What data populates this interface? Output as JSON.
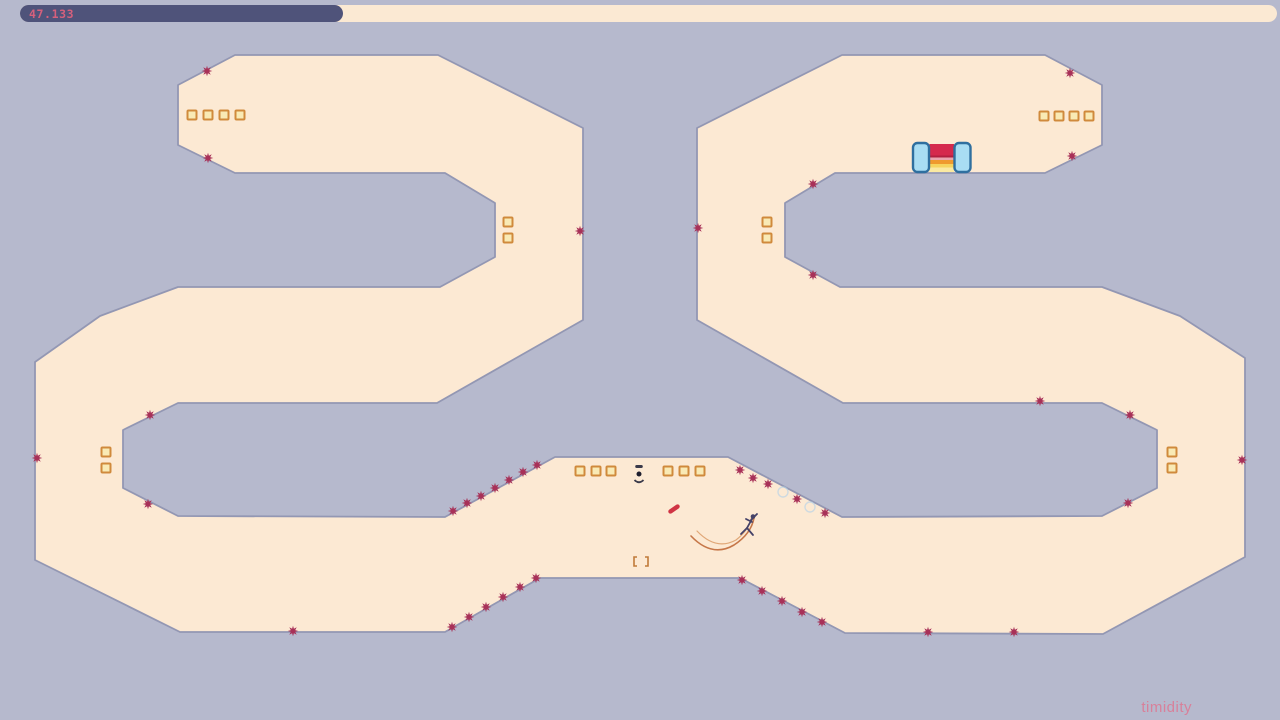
{
  "hud": {
    "timer_label": "47.133",
    "track": {
      "x": 20,
      "y": 5,
      "w": 1257,
      "h": 17,
      "color": "#fbe9d3"
    },
    "fill": {
      "w": 323,
      "color": "#4f537a"
    },
    "label_color": "#d6607c"
  },
  "level": {
    "name": "timidity",
    "name_color": "#d8809a",
    "name_right": 88,
    "name_bottom": 4,
    "colors": {
      "background": "#b6b9cd",
      "ground": "#fce9d3",
      "edge": "#9397b3",
      "edge_width": 1.8,
      "mine": "#a83158",
      "gold_fill": "#f9eab5",
      "gold_border": "#d08a3c",
      "ninja": "#454268",
      "trail_dark": "#c06a3a",
      "trail_light": "#dda06d",
      "rocket": "#d03444",
      "door_pillar_fill": "#a9ddf3",
      "door_pillar_stroke": "#2f6f9f",
      "switch_dark": "#3a3a4a",
      "switch_dot": "#1e1e2e",
      "bracket": "#c07a3a",
      "ghost_circle": "#b5d2e8"
    },
    "terrain_outline": [
      [
        235,
        55
      ],
      [
        438,
        55
      ],
      [
        583,
        128
      ],
      [
        583,
        320
      ],
      [
        437,
        403
      ],
      [
        178,
        403
      ],
      [
        123,
        430
      ],
      [
        123,
        488
      ],
      [
        178,
        516
      ],
      [
        445,
        517
      ],
      [
        555,
        457
      ],
      [
        728,
        457
      ],
      [
        842,
        517
      ],
      [
        1102,
        516
      ],
      [
        1157,
        488
      ],
      [
        1157,
        430
      ],
      [
        1102,
        403
      ],
      [
        843,
        403
      ],
      [
        697,
        320
      ],
      [
        697,
        128
      ],
      [
        842,
        55
      ],
      [
        1045,
        55
      ],
      [
        1102,
        85
      ],
      [
        1102,
        145
      ],
      [
        1045,
        173
      ],
      [
        835,
        173
      ],
      [
        785,
        203
      ],
      [
        785,
        257
      ],
      [
        840,
        287
      ],
      [
        1102,
        287
      ],
      [
        1180,
        316
      ],
      [
        1245,
        358
      ],
      [
        1245,
        557
      ],
      [
        1103,
        634
      ],
      [
        845,
        633
      ],
      [
        740,
        578
      ],
      [
        540,
        578
      ],
      [
        445,
        632
      ],
      [
        180,
        632
      ],
      [
        35,
        560
      ],
      [
        35,
        362
      ],
      [
        100,
        316
      ],
      [
        178,
        287
      ],
      [
        440,
        287
      ],
      [
        495,
        257
      ],
      [
        495,
        203
      ],
      [
        445,
        173
      ],
      [
        235,
        173
      ],
      [
        178,
        145
      ],
      [
        178,
        85
      ]
    ],
    "mines": [
      [
        207,
        71
      ],
      [
        208,
        158
      ],
      [
        580,
        231
      ],
      [
        150,
        415
      ],
      [
        148,
        504
      ],
      [
        37,
        458
      ],
      [
        293,
        631
      ],
      [
        452,
        627
      ],
      [
        469,
        617
      ],
      [
        486,
        607
      ],
      [
        503,
        597
      ],
      [
        520,
        587
      ],
      [
        536,
        578
      ],
      [
        453,
        511
      ],
      [
        467,
        503
      ],
      [
        481,
        496
      ],
      [
        495,
        488
      ],
      [
        509,
        480
      ],
      [
        523,
        472
      ],
      [
        537,
        465
      ],
      [
        740,
        470
      ],
      [
        753,
        478
      ],
      [
        768,
        484
      ],
      [
        797,
        499
      ],
      [
        825,
        513
      ],
      [
        742,
        580
      ],
      [
        762,
        591
      ],
      [
        782,
        601
      ],
      [
        802,
        612
      ],
      [
        822,
        622
      ],
      [
        928,
        632
      ],
      [
        1014,
        632
      ],
      [
        1040,
        401
      ],
      [
        1130,
        415
      ],
      [
        1128,
        503
      ],
      [
        1242,
        460
      ],
      [
        698,
        228
      ],
      [
        813,
        184
      ],
      [
        813,
        275
      ],
      [
        1070,
        73
      ],
      [
        1072,
        156
      ]
    ],
    "golds": [
      [
        192,
        115
      ],
      [
        208,
        115
      ],
      [
        224,
        115
      ],
      [
        240,
        115
      ],
      [
        1044,
        116
      ],
      [
        1059,
        116
      ],
      [
        1074,
        116
      ],
      [
        1089,
        116
      ],
      [
        508,
        222
      ],
      [
        508,
        238
      ],
      [
        767,
        222
      ],
      [
        767,
        238
      ],
      [
        106,
        452
      ],
      [
        106,
        468
      ],
      [
        1172,
        452
      ],
      [
        1172,
        468
      ],
      [
        580,
        471
      ],
      [
        596,
        471
      ],
      [
        611,
        471
      ],
      [
        668,
        471
      ],
      [
        684,
        471
      ],
      [
        700,
        471
      ]
    ],
    "gold_size": 9,
    "exit_door": {
      "stripes_x": 929.5,
      "stripes_w": 24.5,
      "stripes": [
        {
          "y": 144,
          "h": 12,
          "color": "#d5294d"
        },
        {
          "y": 155.5,
          "h": 2,
          "color": "#b21f40"
        },
        {
          "y": 157.5,
          "h": 2.5,
          "color": "#eaa3ad"
        },
        {
          "y": 160,
          "h": 4,
          "color": "#ef9a2e"
        },
        {
          "y": 164,
          "h": 3.5,
          "color": "#f6d45e"
        },
        {
          "y": 167.5,
          "h": 4.5,
          "color": "#fae9a2"
        }
      ],
      "left_pillar": {
        "x": 913,
        "y": 143,
        "w": 16,
        "h": 29
      },
      "right_pillar": {
        "x": 954.5,
        "y": 143,
        "w": 16,
        "h": 29
      }
    },
    "door_switch": {
      "x": 639,
      "y": 474
    },
    "trapdoor_brackets": {
      "x1": 634,
      "x2": 648,
      "top": 557,
      "bottom": 566
    },
    "rocket": {
      "x": 674,
      "y": 509,
      "len": 13,
      "w": 4.4,
      "angle": -35
    },
    "ninja": {
      "head": [
        753,
        516.5,
        2.3
      ],
      "limbs": [
        [
          752,
          519,
          747,
          528
        ],
        [
          751,
          520,
          757,
          514
        ],
        [
          752,
          522,
          746,
          519
        ],
        [
          747,
          528,
          741,
          534
        ],
        [
          747,
          528,
          753,
          535
        ]
      ]
    },
    "trails": [
      {
        "d": "M 691 536 Q 712 558 734 545 Q 751 534 754 518",
        "w": 1.6,
        "color_key": "trail_dark"
      },
      {
        "d": "M 697 531 Q 716 551 736 540 Q 749 530 752 516",
        "w": 1.2,
        "color_key": "trail_light"
      }
    ],
    "ghost_circles": [
      [
        783,
        492,
        5
      ],
      [
        810,
        507,
        5
      ]
    ]
  }
}
